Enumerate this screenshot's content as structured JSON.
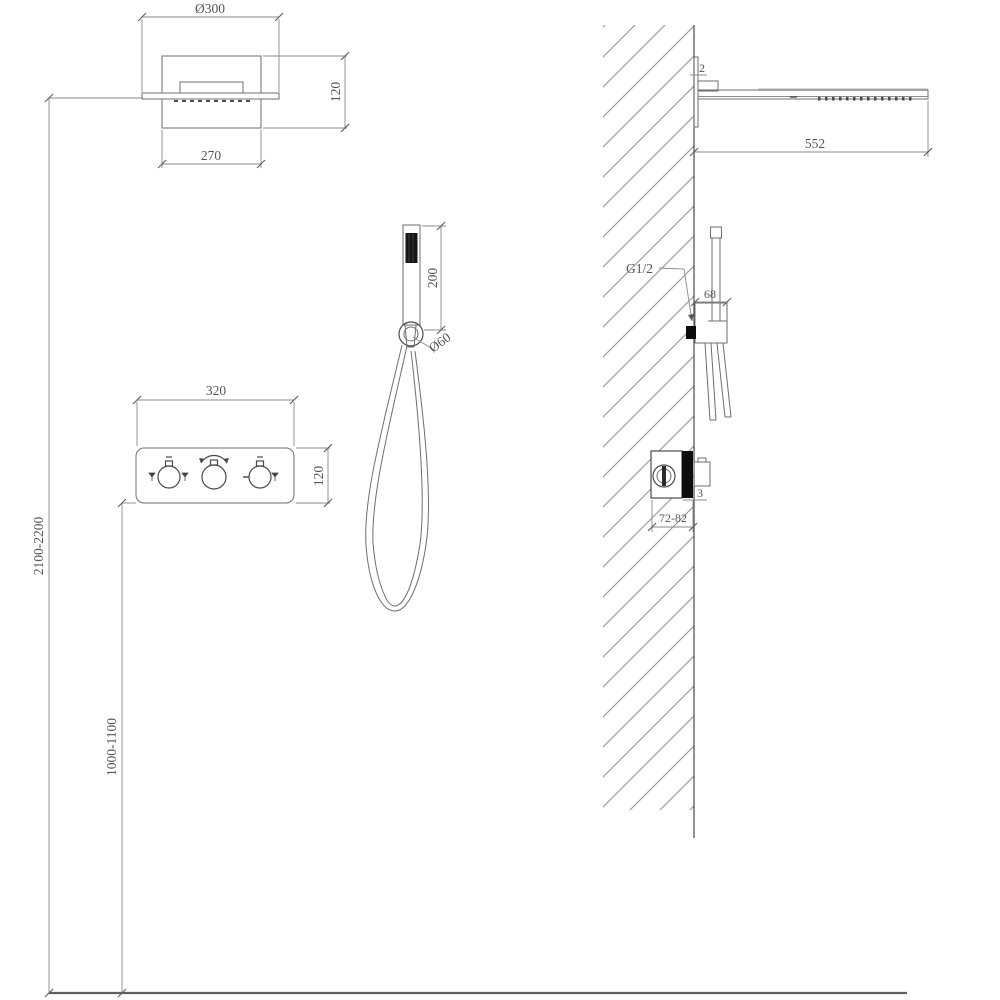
{
  "drawing": {
    "type": "shower-system-installation-diagram",
    "front_view": {
      "rain_head": {
        "diameter": "Ø300",
        "height": "120",
        "width": "270"
      },
      "valve_panel": {
        "width": "320",
        "height": "120"
      },
      "hand_shower": {
        "length": "200",
        "holder_diameter": "Ø60"
      },
      "install_heights": {
        "head_outlet": "2100-2200",
        "valve_panel": "1000-1100"
      }
    },
    "side_view": {
      "rain_head": {
        "plate_thickness": "2",
        "projection": "552"
      },
      "hand_shower": {
        "connector_thread": "G1/2",
        "bracket_width": "68"
      },
      "valve": {
        "trim_thickness": "3",
        "rough_in_depth": "72-82"
      }
    },
    "icons": {
      "left_knob_side": "tap-icon",
      "middle_knob_top": "rotate-arc-icon",
      "right_knob_left": "minus-icon",
      "right_knob_right": "tap-icon"
    },
    "colors": {
      "line": "#6e6e6e",
      "dim_text": "#555555",
      "solid_parts": "#0d0d0d",
      "hatch": "#8f8f8f"
    }
  }
}
